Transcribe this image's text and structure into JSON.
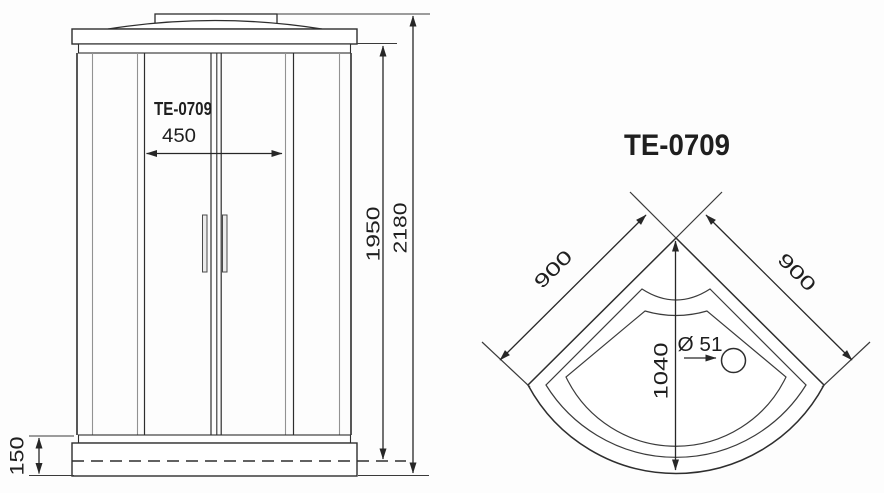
{
  "page": {
    "background": "#fdfdfd",
    "line_color": "#2e2e2e",
    "description": "Technical dimension drawing of TE-0709 corner shower cabin: front elevation and tray plan view"
  },
  "front_view": {
    "model_label": "TE-0709",
    "dims": {
      "door_width": "450",
      "glass_height": "1950",
      "total_height": "2180",
      "tray_height": "150"
    }
  },
  "plan_view": {
    "model_label": "TE-0709",
    "dims": {
      "left_side": "900",
      "right_side": "900",
      "diagonal": "1040",
      "drain": "Ø 51"
    }
  }
}
